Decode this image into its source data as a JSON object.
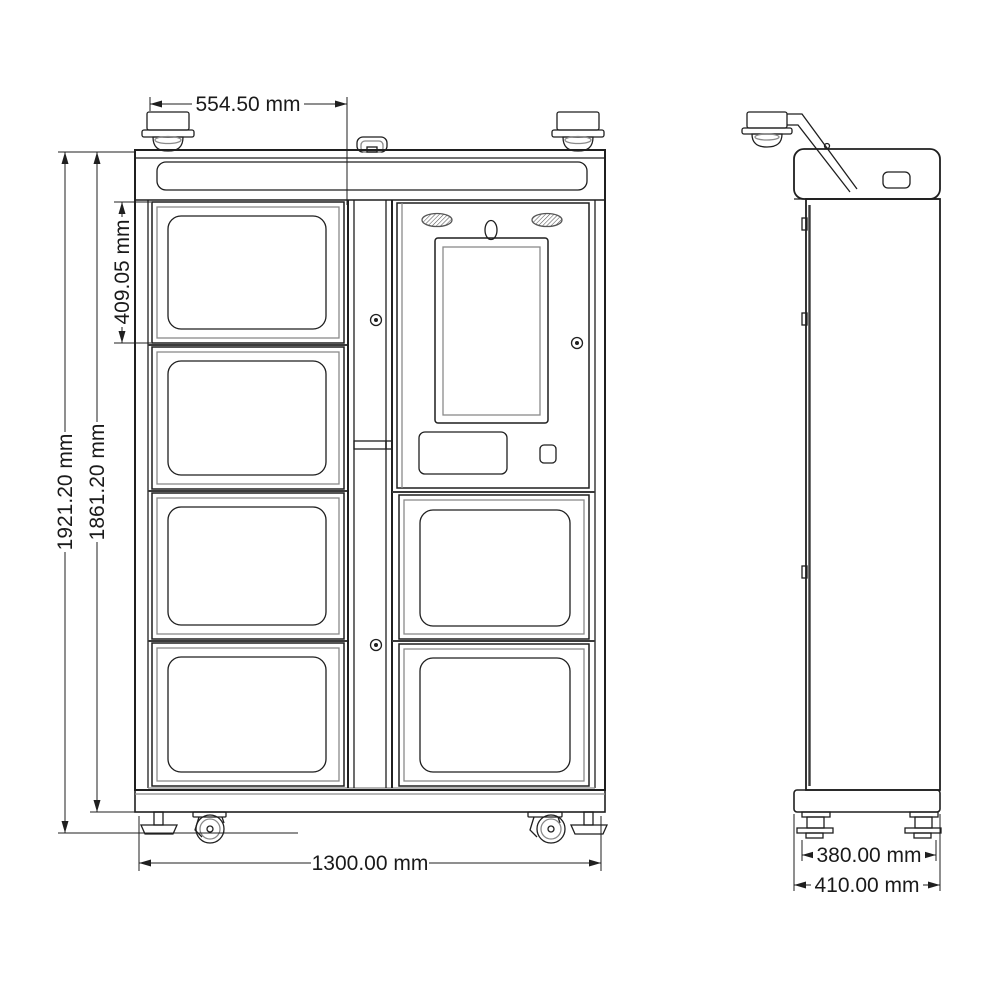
{
  "dimensions": {
    "top_width": "554.50 mm",
    "compartment_height": "409.05 mm",
    "overall_height": "1921.20 mm",
    "cabinet_height": "1861.20 mm",
    "overall_width": "1300.00 mm",
    "foot_spacing_depth": "380.00 mm",
    "overall_depth": "410.00 mm"
  },
  "colors": {
    "line": "#1f1f1f",
    "line_light": "#8a8a8a",
    "background": "#ffffff",
    "text": "#1a1a1a"
  }
}
